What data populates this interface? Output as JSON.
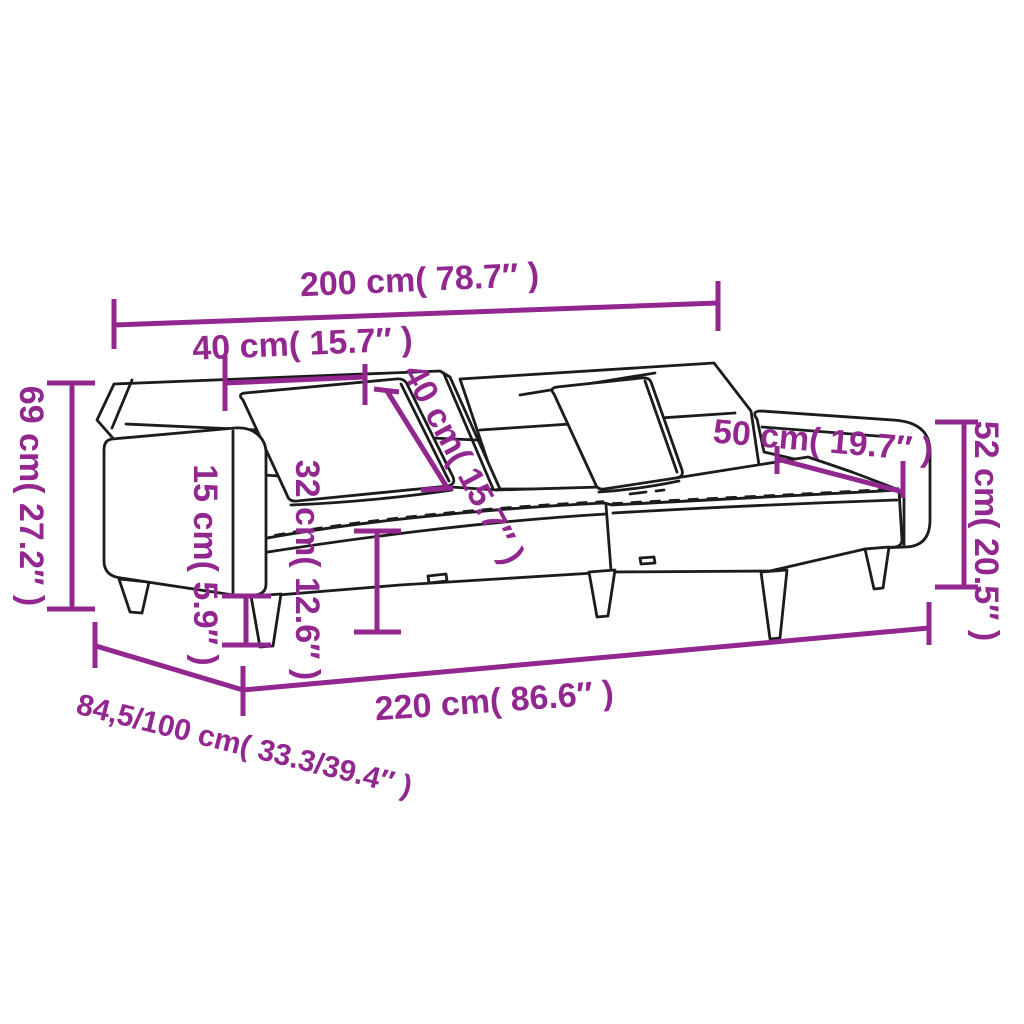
{
  "image": {
    "title": "Sofa bed dimension diagram",
    "accent_color": "#92278F",
    "line_color": "#1c1c1c"
  },
  "dimensions": {
    "total_width": "200 cm( 78.7″ )",
    "pillow_width": "40 cm( 15.7″ )",
    "pillow_height": "40 cm( 15.7″ )",
    "overall_height": "69 cm( 27.2″ )",
    "leg_height": "15 cm( 5.9″ )",
    "seat_height": "32 cm( 12.6″ )",
    "armrest_length": "50 cm( 19.7″ )",
    "armrest_height": "52 cm( 20.5″ )",
    "total_length": "220 cm( 86.6″ )",
    "depth_range": "84,5/100 cm( 33.3/39.4″ )"
  }
}
